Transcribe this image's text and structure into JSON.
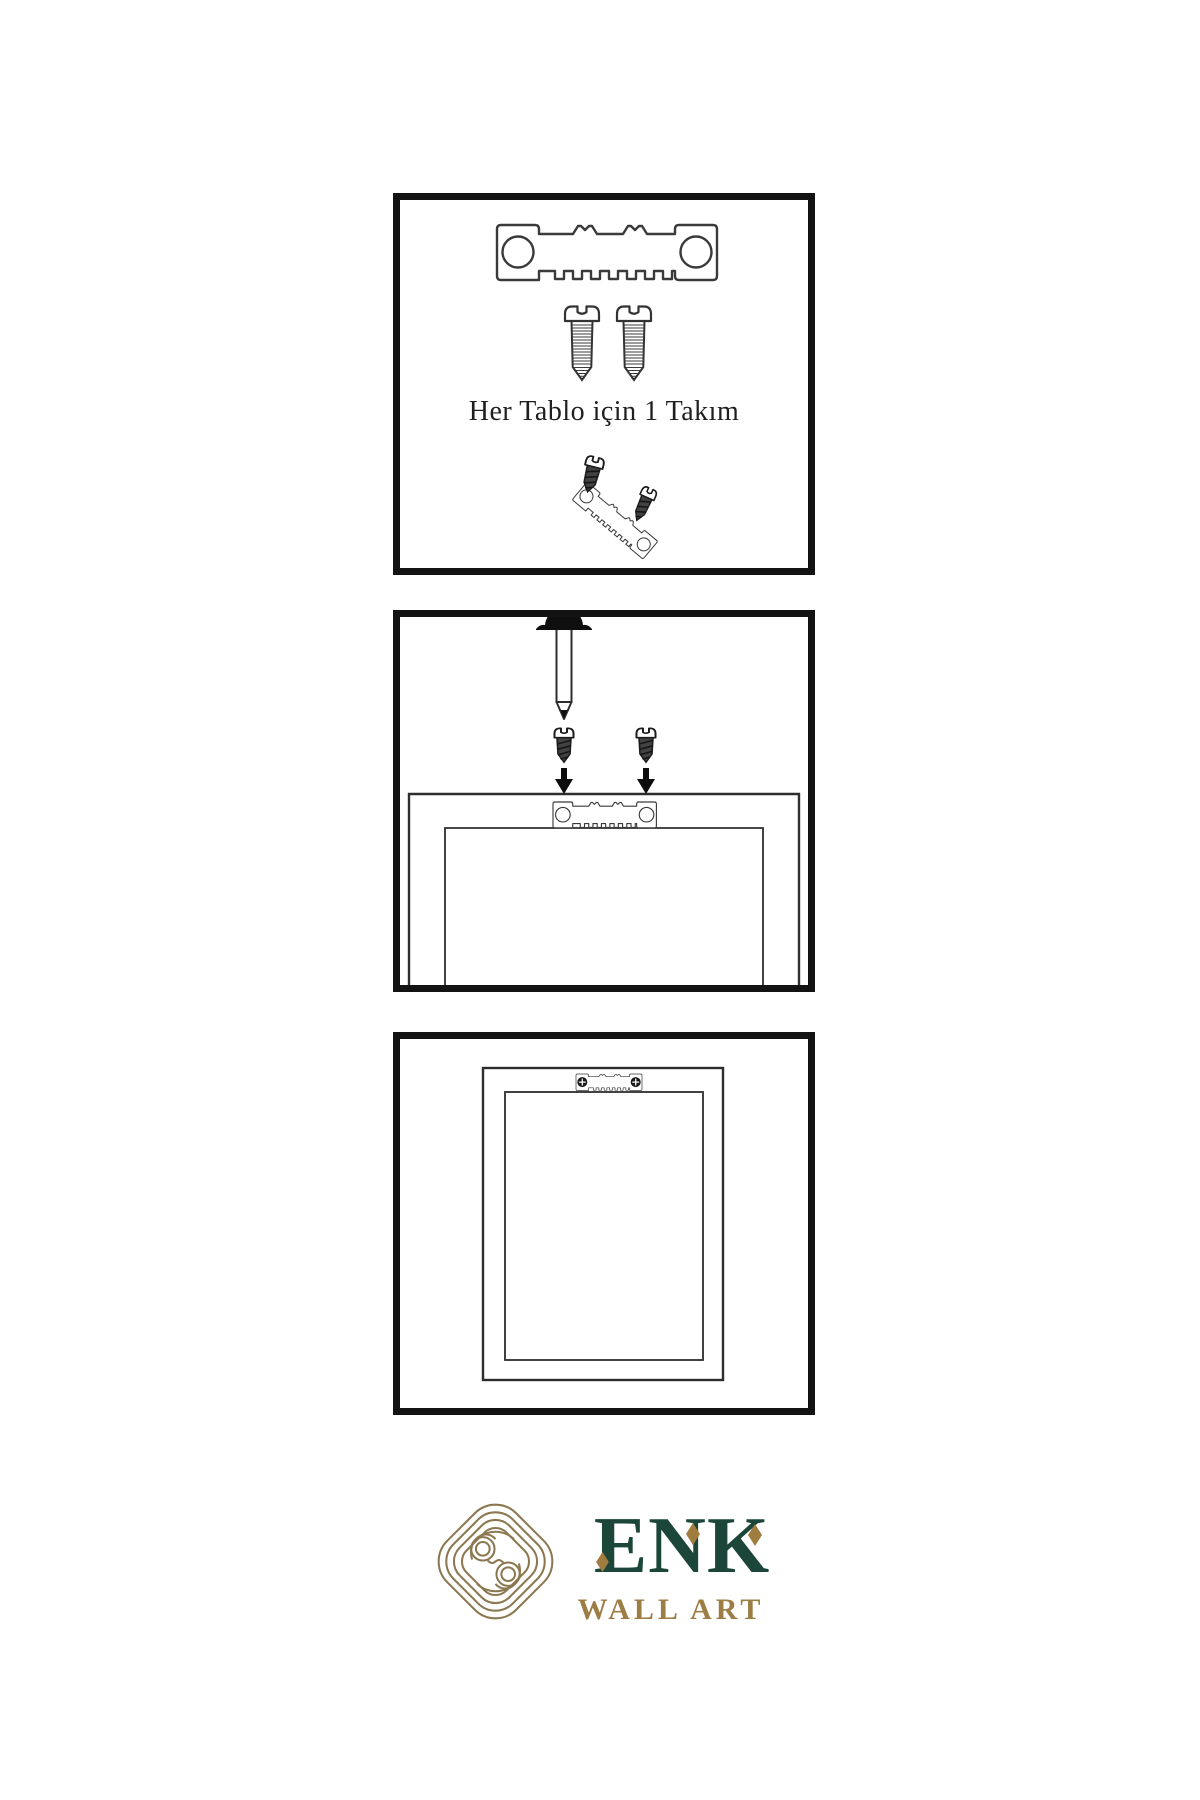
{
  "page": {
    "background": "#ffffff"
  },
  "panels": [
    {
      "name": "hardware-kit",
      "caption": "Her Tablo için 1 Takım",
      "contents": [
        "sawtooth-hanger",
        "screw",
        "screw",
        "screw",
        "screw",
        "tilted-sawtooth-hanger"
      ]
    },
    {
      "name": "mark-and-screw",
      "caption": "",
      "contents": [
        "wall-nail",
        "screw",
        "screw",
        "down-arrow",
        "down-arrow",
        "frame-back",
        "sawtooth-hanger"
      ]
    },
    {
      "name": "hang-frame",
      "caption": "",
      "contents": [
        "frame-front",
        "sawtooth-hanger",
        "phillips-screw",
        "phillips-screw"
      ]
    }
  ],
  "logo": {
    "brand": "ENK",
    "subtitle": "WALL ART",
    "colors": {
      "green": "#1b4639",
      "gold": "#9c7e44",
      "knot": "#8b7850",
      "diamond": "#a07c3e"
    }
  },
  "artwork": {
    "line_color": "#2e2e2e",
    "panel_border": "#131313"
  }
}
